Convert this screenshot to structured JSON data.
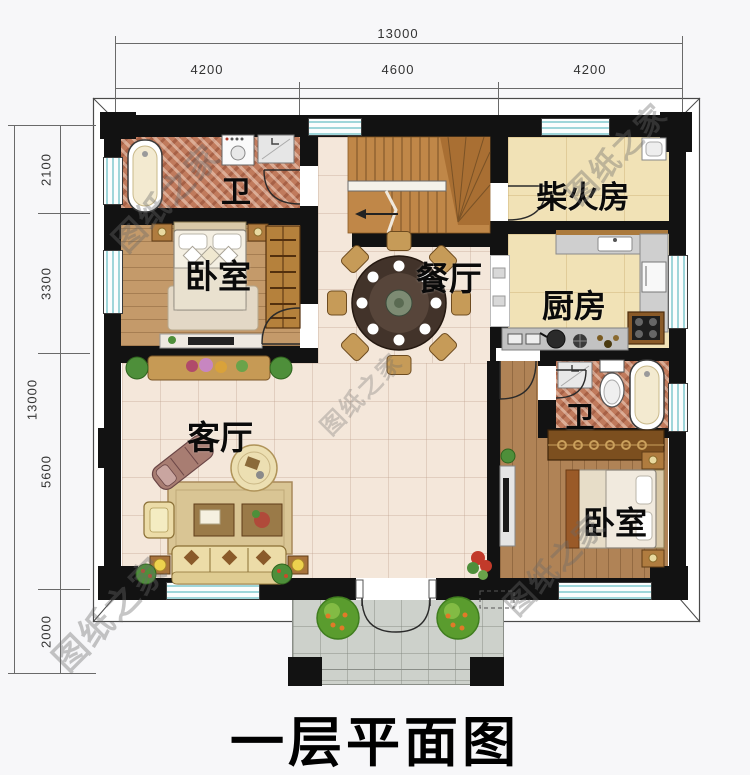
{
  "title": {
    "text": "一层平面图"
  },
  "watermark": {
    "text": "图纸之家"
  },
  "dimensions": {
    "top": {
      "total": "13000",
      "segments": [
        "4200",
        "4600",
        "4200"
      ]
    },
    "left": {
      "total": "13000",
      "segments": [
        "2100",
        "3300",
        "5600",
        "2000"
      ]
    }
  },
  "rooms": {
    "bath1": {
      "label": "卫"
    },
    "bedroom1": {
      "label": "卧室"
    },
    "living": {
      "label": "客厅"
    },
    "dining": {
      "label": "餐厅"
    },
    "firewood": {
      "label": "柴火房"
    },
    "kitchen": {
      "label": "厨房"
    },
    "bath2": {
      "label": "卫"
    },
    "bedroom2": {
      "label": "卧室"
    }
  },
  "colors": {
    "wall": "#121212",
    "window_glass": "#9fd6da",
    "floor_tile": "#f4e7da",
    "floor_wood": "#c49a6a",
    "floor_mosaic": "#c07a5c",
    "floor_marble": "#f1e2b6",
    "porch": "#cdd1cb",
    "stairs": "#c08748"
  }
}
